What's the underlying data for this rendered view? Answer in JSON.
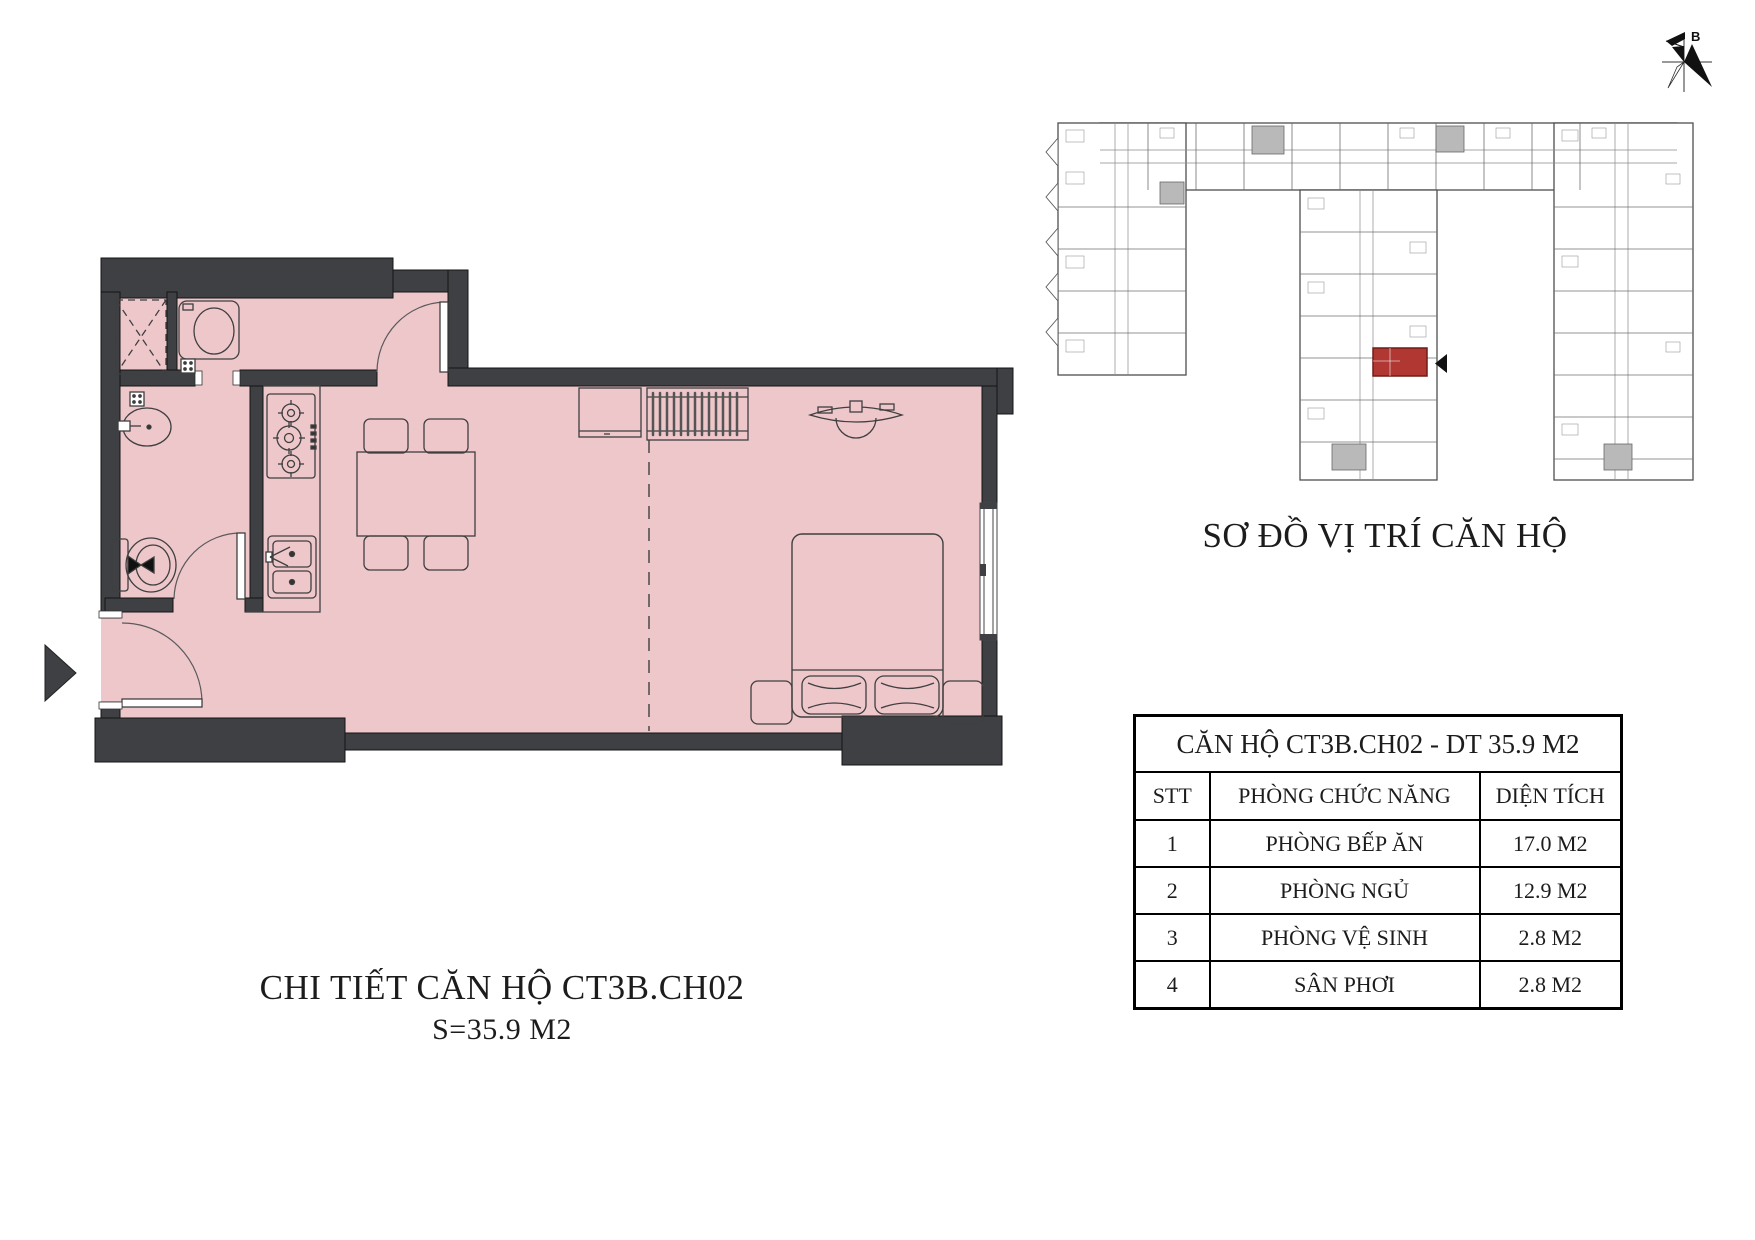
{
  "colors": {
    "floor": "#eec7cb",
    "wall": "#3e4043",
    "furniture_line": "#3f3f3f",
    "site_line": "#4f4f4f",
    "highlight_unit": "#b13832",
    "highlight_border": "#701b17",
    "text": "#1c1c1c"
  },
  "north_arrow": {
    "label": "B"
  },
  "site_plan": {
    "title": "SƠ ĐỒ VỊ TRÍ CĂN HỘ"
  },
  "floor_plan": {
    "title": "CHI TIẾT CĂN HỘ CT3B.CH02",
    "subtitle": "S=35.9 M2"
  },
  "table": {
    "title": "CĂN HỘ CT3B.CH02 - DT 35.9 M2",
    "headers": [
      "STT",
      "PHÒNG CHỨC NĂNG",
      "DIỆN TÍCH"
    ],
    "rows": [
      {
        "stt": "1",
        "room": "PHÒNG BẾP ĂN",
        "area": "17.0 M2"
      },
      {
        "stt": "2",
        "room": "PHÒNG NGỦ",
        "area": "12.9 M2"
      },
      {
        "stt": "3",
        "room": "PHÒNG VỆ SINH",
        "area": "2.8 M2"
      },
      {
        "stt": "4",
        "room": "SÂN PHƠI",
        "area": "2.8 M2"
      }
    ]
  }
}
